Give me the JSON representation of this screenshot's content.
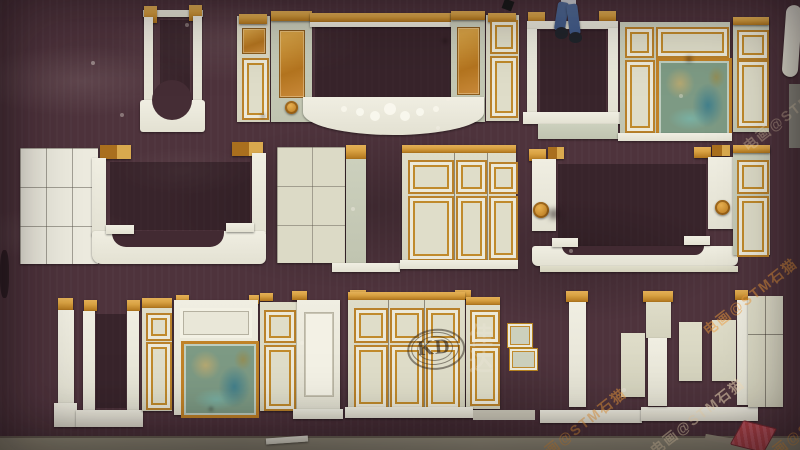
{
  "scene": {
    "subject": "Overhead photograph of carved marble fireplace surrounds and wall panel pieces with gold trim and green onyx inlays, laid out in three rows on a dark plum carpet over a concrete floor; a person's legs are visible at the top edge",
    "watermarks": {
      "logo_text": "KD",
      "logo_cn_chars": "佳\n达",
      "diagonal_text": "电画@STM石猫"
    },
    "palette": {
      "carpet": "#4e333c",
      "carpetDark": "#38242c",
      "concrete": "#938d7a",
      "white": "#f0eee2",
      "cream": "#dfddc9",
      "sage": "#ccd0bd",
      "gold": "#d9a243",
      "goldDark": "#b0751c",
      "amber": "#c07e2e",
      "green": "#7d9a84",
      "jeans": "#3e5784",
      "red": "#b5434a"
    }
  }
}
